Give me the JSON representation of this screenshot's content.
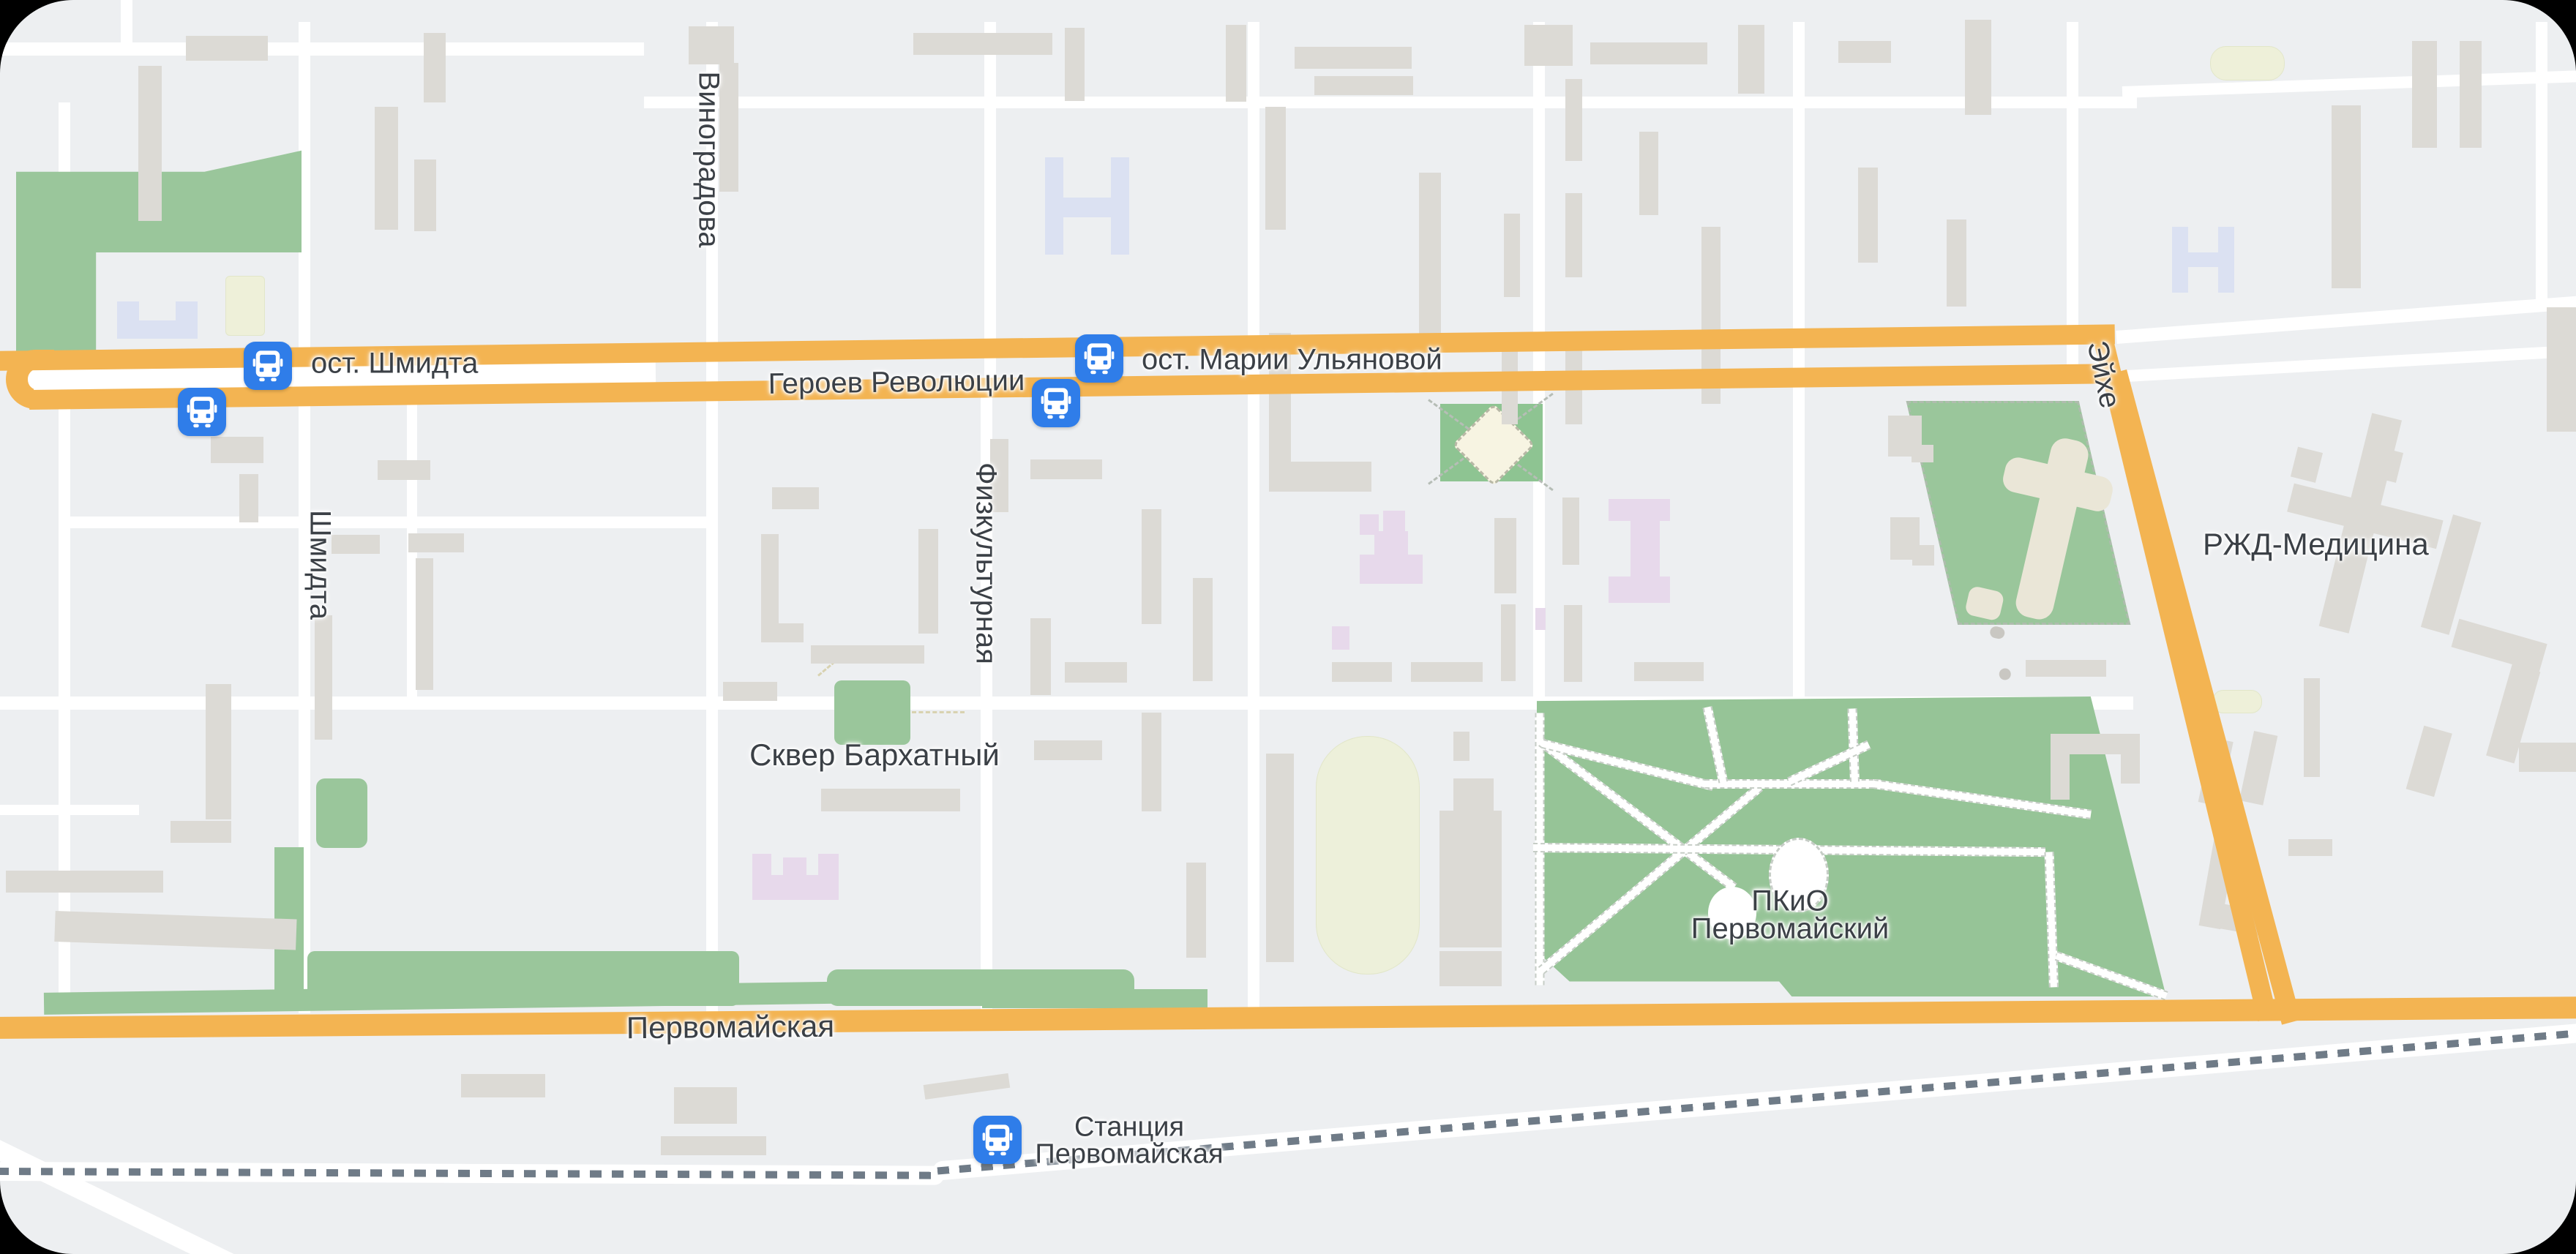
{
  "roads": {
    "geroev_revolyutsii": "Героев Революции",
    "pervomayskaya": "Первомайская",
    "eykhe": "Эйхе",
    "shmidta": "Шмидта",
    "vinogradova": "Виноградова",
    "fizkulturnaya": "Физкультурная"
  },
  "stops": {
    "shmidta": "ост. Шмидта",
    "marii_ulyanovoy": "ост. Марии Ульяновой",
    "station_line1": "Станция",
    "station_line2": "Первомайская"
  },
  "places": {
    "skver_barkhatny": "Сквер Бархатный",
    "pkio_line1": "ПКиО",
    "pkio_line2": "Первомайский",
    "rzhd_meditsina": "РЖД-Медицина"
  },
  "icons": {
    "stop_marker": "bus-icon"
  },
  "colors": {
    "road": "#f3b452",
    "green": "#9ac69b",
    "building": "#dcdad5",
    "school_building": "#e7d9eb",
    "public_building": "#dbe1f2",
    "stop_marker": "#2f7de9",
    "background": "#edeff1",
    "label_text": "#3b4046",
    "rail_dash": "#6f7b87"
  }
}
